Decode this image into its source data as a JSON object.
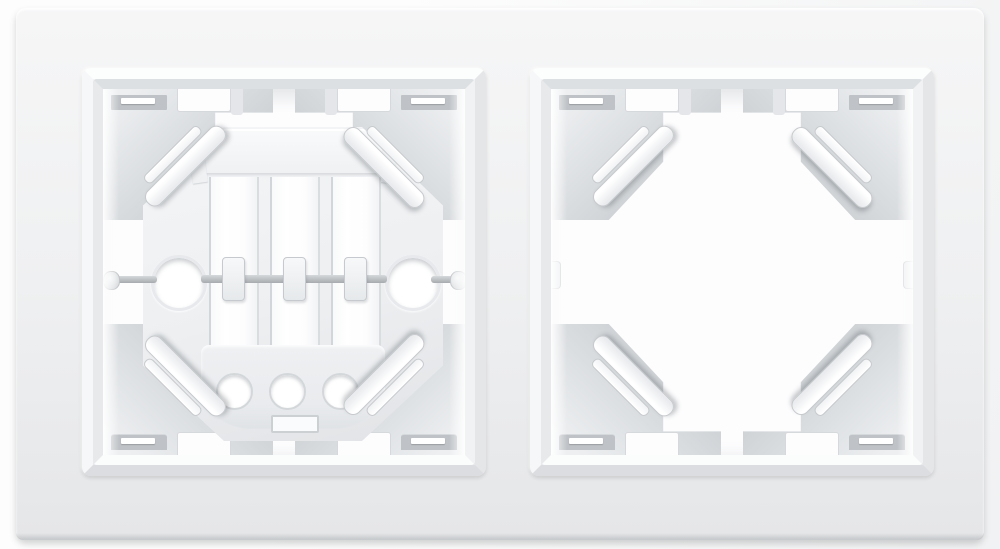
{
  "meta": {
    "description": "Product photo: white two-gang electrical wall switch frame viewed from the front; the left square window contains a switch mounting cradle with slots, screw holes and an axle rod, the right square window is empty showing only corner latch clips.",
    "image_width_px": 1000,
    "image_height_px": 549
  },
  "product": {
    "plate": {
      "material_look": "matte white plastic",
      "rounded_corners": true
    },
    "windows": [
      {
        "name": "left-frame-window",
        "contains": "mounting-cradle",
        "corner_clips": 4,
        "top_notches": 2,
        "bottom_notches": 2
      },
      {
        "name": "right-frame-window",
        "contains": "empty",
        "corner_clips": 4,
        "top_notches": 2,
        "bottom_notches": 2
      }
    ],
    "mounting_cradle": {
      "shape": "octagonal plate",
      "vertical_slots": 3,
      "side_screw_holes": 2,
      "bottom_holes": 3,
      "axle_rod": true,
      "rod_clips": 3,
      "bottom_slot": 1
    }
  },
  "colors": {
    "scene-bg-1": "#fdfdfd",
    "scene-bg-2": "#f1f2f3",
    "plate-1": "#f6f6f7",
    "plate-2": "#eff0f1",
    "plate-3": "#e5e6e8",
    "plate-edge": "#bfc2c5",
    "bevel-top": "#fcfdfd",
    "bevel-right": "#e4e6e8",
    "bevel-bottom": "#dbdde0",
    "bevel-left": "#f6f7f8",
    "bevel-in-top": "#dde0e3",
    "bevel-in-right": "#f1f2f4",
    "bevel-in-bottom": "#fbfcfc",
    "bevel-in-left": "#e7e9eb",
    "cavity": "#fdfdfe",
    "wall-1": "#edeff1",
    "wall-2": "#cfd3d6",
    "wall-3": "#c2c6ca",
    "slot-dark": "#bfc3c7",
    "tab-white": "#fdfdfe",
    "tab-border": "#d6d9dc",
    "clip-border": "#c7cacd",
    "clip-grad-1": "#ffffff",
    "clip-grad-2": "#e9ebee",
    "mech-1": "#f4f5f7",
    "mech-2": "#edeff1",
    "mech-3": "#e1e3e6",
    "mech-border": "#d2d5d9",
    "hole-rim": "#e7e9ec",
    "rod-1": "#d6d9db",
    "rod-2": "#a7abaf"
  }
}
